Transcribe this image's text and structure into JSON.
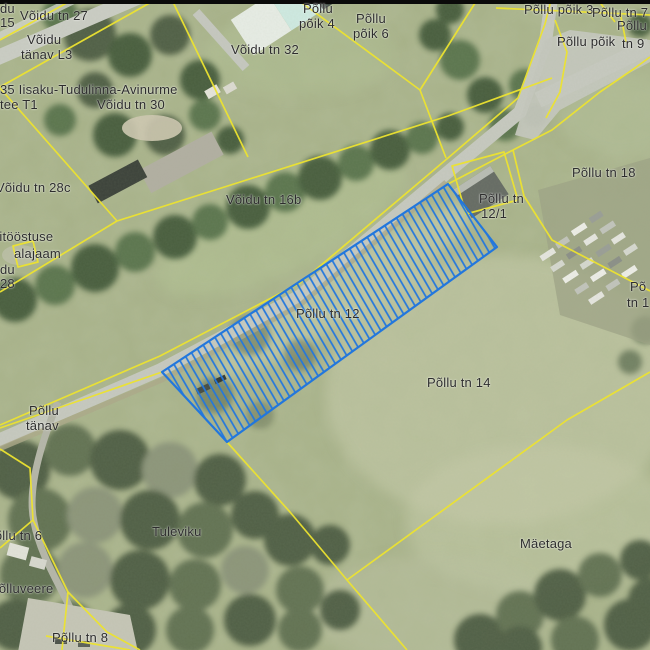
{
  "map": {
    "selected_parcel": {
      "name": "Põllu tn 12",
      "style": "blue-hatched-selection"
    },
    "colors": {
      "parcel_boundary_yellow": "#ece32f",
      "selected_parcel_blue": "#2277dd",
      "label_text": "#2d2d2d",
      "road_gray": "#c7c9c0",
      "top_bar_black": "#0a0a0a"
    },
    "labels": [
      {
        "text": "du",
        "x": 0,
        "y": 2
      },
      {
        "text": "15",
        "x": 0,
        "y": 16
      },
      {
        "text": "Võidu tn 27",
        "x": 20,
        "y": 9
      },
      {
        "text": "Võidu",
        "x": 27,
        "y": 33
      },
      {
        "text": "tänav L3",
        "x": 21,
        "y": 48
      },
      {
        "text": "35 Iisaku-Tudulinna-Avinurme",
        "x": 0,
        "y": 83
      },
      {
        "text": "tee T1",
        "x": 0,
        "y": 98
      },
      {
        "text": "Võidu tn 30",
        "x": 97,
        "y": 98
      },
      {
        "text": "Võidu tn 32",
        "x": 231,
        "y": 43
      },
      {
        "text": "Põllu",
        "x": 303,
        "y": 2
      },
      {
        "text": "põik 4",
        "x": 299,
        "y": 17
      },
      {
        "text": "Põllu",
        "x": 356,
        "y": 12
      },
      {
        "text": "põik 6",
        "x": 353,
        "y": 27
      },
      {
        "text": "Põllu põik 3",
        "x": 524,
        "y": 3
      },
      {
        "text": "Põllu tn 7",
        "x": 592,
        "y": 6
      },
      {
        "text": "Põllu",
        "x": 617,
        "y": 19
      },
      {
        "text": "Põllu põik",
        "x": 557,
        "y": 35
      },
      {
        "text": "tn 9",
        "x": 622,
        "y": 37
      },
      {
        "text": "Võidu tn 28c",
        "x": -4,
        "y": 181
      },
      {
        "text": "Võidu tn 16b",
        "x": 226,
        "y": 193
      },
      {
        "text": "pitööstuse",
        "x": -8,
        "y": 230
      },
      {
        "text": "alajaam",
        "x": 14,
        "y": 247
      },
      {
        "text": "du",
        "x": 0,
        "y": 263
      },
      {
        "text": "28",
        "x": 0,
        "y": 277
      },
      {
        "text": "Põllu tn 18",
        "x": 572,
        "y": 166
      },
      {
        "text": "Põllu tn",
        "x": 479,
        "y": 192
      },
      {
        "text": "12/1",
        "x": 481,
        "y": 207
      },
      {
        "text": "Põllu tn 12",
        "x": 296,
        "y": 307
      },
      {
        "text": "Põllu tn 14",
        "x": 427,
        "y": 376
      },
      {
        "text": "Põ",
        "x": 630,
        "y": 280
      },
      {
        "text": "tn 1",
        "x": 627,
        "y": 296
      },
      {
        "text": "Põllu",
        "x": 29,
        "y": 404
      },
      {
        "text": "tänav",
        "x": 26,
        "y": 419
      },
      {
        "text": "Põllu tn 6",
        "x": -14,
        "y": 529
      },
      {
        "text": "Tuleviku",
        "x": 152,
        "y": 525
      },
      {
        "text": "Põlluveere",
        "x": -10,
        "y": 582
      },
      {
        "text": "Mäetaga",
        "x": 520,
        "y": 537
      },
      {
        "text": "Põllu tn 8",
        "x": 52,
        "y": 631
      }
    ]
  }
}
